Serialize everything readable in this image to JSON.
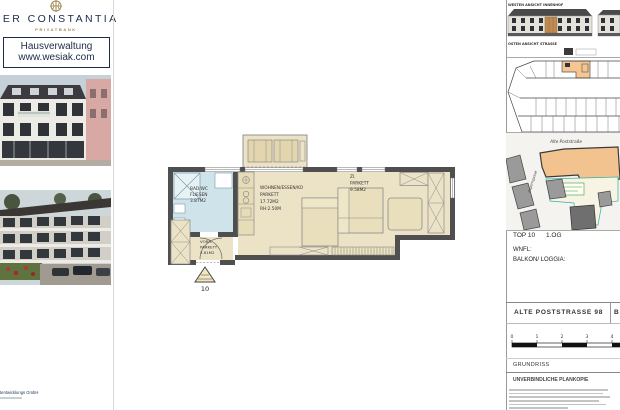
{
  "sidebar": {
    "logo": {
      "title": "PER CONSTANTIA",
      "subtitle": "PRIVATBANK"
    },
    "contact": {
      "line1": "Hausverwaltung",
      "line2": "www.wesiak.com"
    },
    "footer_company": "tentwicklungs GmbH"
  },
  "floor_plan": {
    "rooms": [
      {
        "name": "BAD/WC",
        "floor": "FLIESEN",
        "area": "3.87M2"
      },
      {
        "name": "WOHNEN/ESSEN/KO",
        "floor": "PARKETT",
        "area": "17.72M2",
        "extra": "RH:2.50M"
      },
      {
        "name": "ZI.",
        "floor": "PARKETT",
        "area": "9.58M2"
      },
      {
        "name": "VORR.",
        "floor": "PARKETT",
        "area": "3.81M2"
      }
    ],
    "entrance_label": "10"
  },
  "title_block": {
    "elevations": {
      "top_label": "WESTEN ANSICHT INNENHOF",
      "bottom_label": "OSTEN ANSICHT STRASSE"
    },
    "site": {
      "street_top": "Alte Poststraße",
      "street_side": "Asperngasse"
    },
    "unit": {
      "top": "TOP 10",
      "level": "1.OG",
      "wnfl_label": "WNFL:",
      "balkon_label": "BALKON/ LOGGIA:"
    },
    "address": "ALTE POSTSTRASSE 98",
    "address_fragment": "B",
    "scale_ticks": [
      "0",
      "1",
      "2",
      "3",
      "4"
    ],
    "drawing_type": "GRUNDRISS",
    "disclaimer_title": "UNVERBINDLICHE PLANKOPIE"
  },
  "colors": {
    "navy": "#1c2b4a",
    "gold": "#a08850",
    "beige": "#ece2c6",
    "bath_blue": "#cfe3ea",
    "wall_gray": "#4f4f4f",
    "highlight_orange": "#f3c38f"
  }
}
